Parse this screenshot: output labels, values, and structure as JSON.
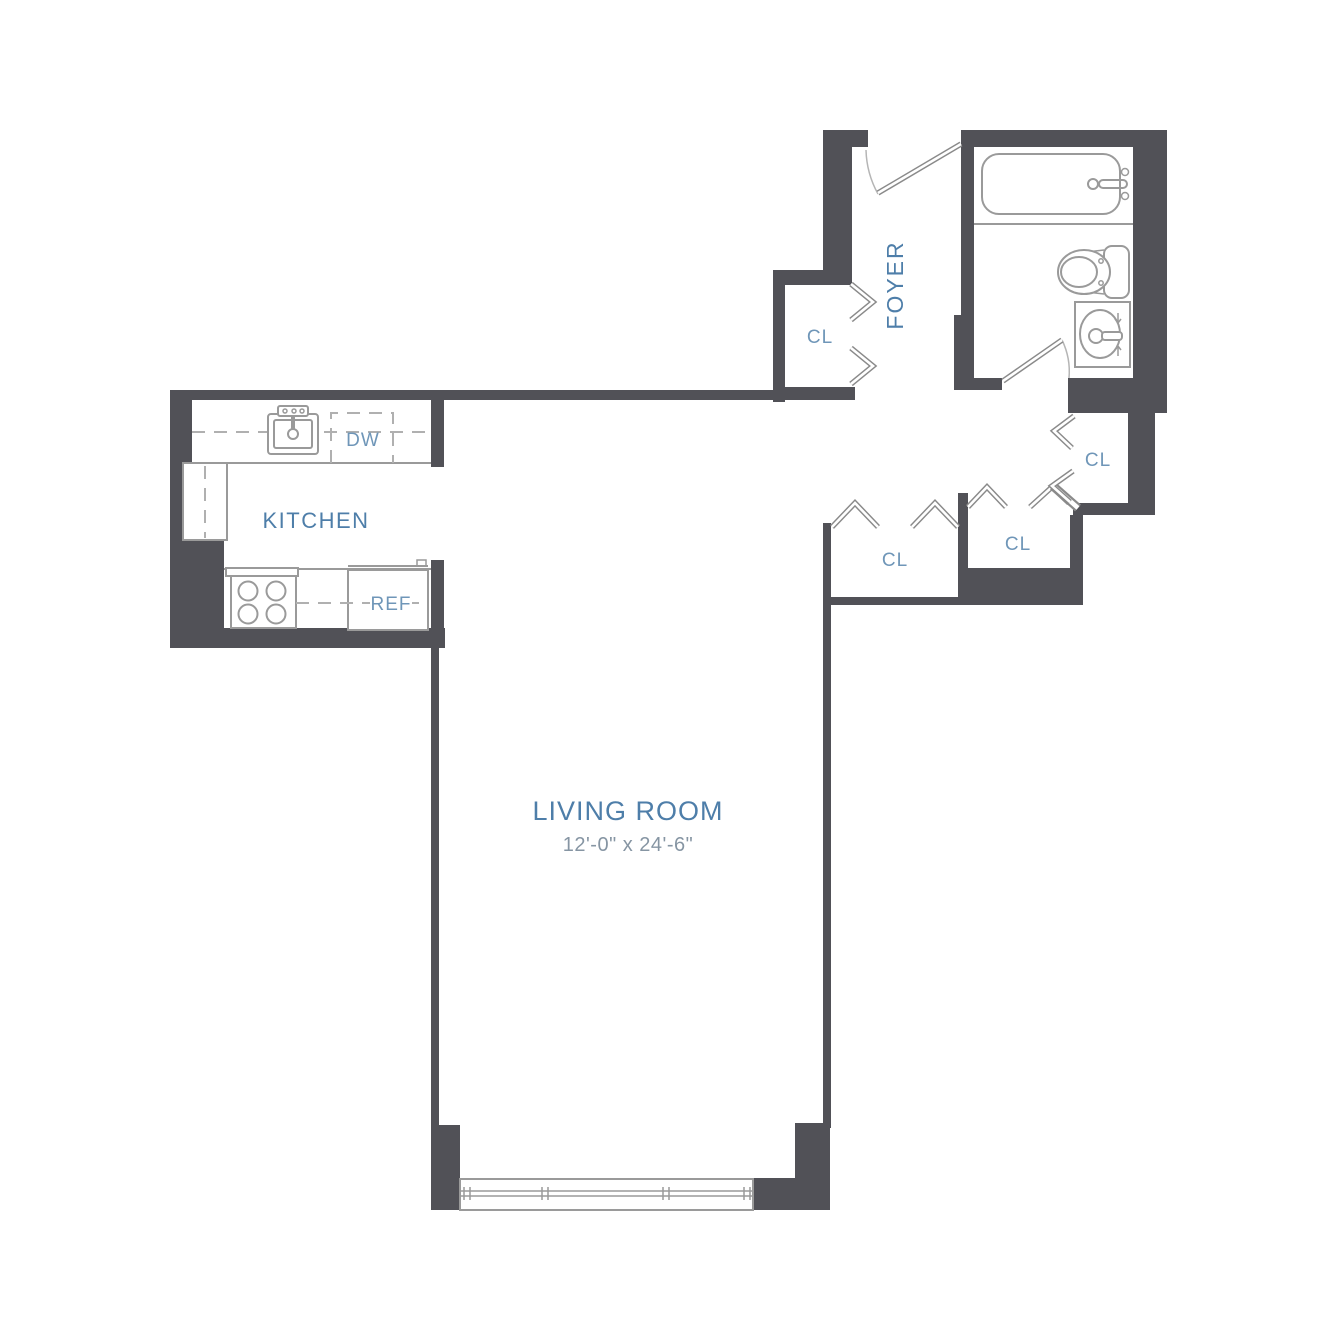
{
  "colors": {
    "background": "#ffffff",
    "wall": "#515157",
    "fixture_line": "#9a9a9a",
    "light_line": "#b5b5b5",
    "dashed_line": "#b0b0b0",
    "room_label": "#4e7ea9",
    "small_label": "#6f96b8",
    "dimension_text": "#8695a3"
  },
  "rooms": {
    "living_room": {
      "label": "LIVING ROOM",
      "dimensions": "12'-0\" x 24'-6\""
    },
    "kitchen": {
      "label": "KITCHEN"
    },
    "foyer": {
      "label": "FOYER"
    },
    "closet_foyer": {
      "label": "CL"
    },
    "closet_hall_left": {
      "label": "CL"
    },
    "closet_hall_middle": {
      "label": "CL"
    },
    "closet_hall_right": {
      "label": "CL"
    }
  },
  "appliances": {
    "dishwasher_label": "DW",
    "refrigerator_label": "REF"
  },
  "fixtures": {
    "bathroom": [
      "bathtub",
      "toilet",
      "vanity-sink"
    ],
    "kitchen": [
      "kitchen-sink",
      "range-stove",
      "refrigerator",
      "dishwasher"
    ],
    "doors_windows": [
      "entry-door",
      "bathroom-door",
      "bifold-closet-doors",
      "living-room-window"
    ]
  }
}
